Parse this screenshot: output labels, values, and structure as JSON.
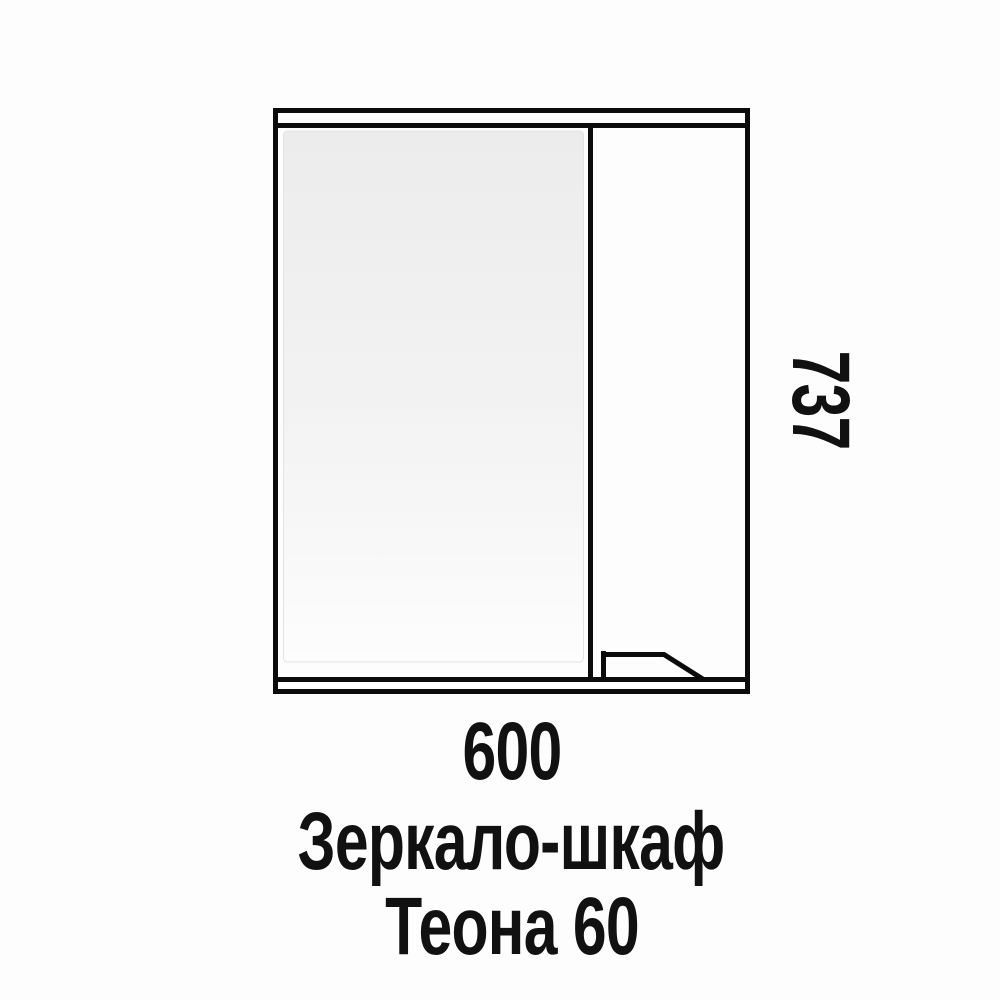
{
  "page": {
    "background": "#fdfdfd"
  },
  "drawing": {
    "stroke_color": "#0b0b0b",
    "mirror_top_color": "#ececec",
    "mirror_bottom_color": "#fdfdfd",
    "mirror_edge_color": "#e3e3e3",
    "width_mm": "600",
    "height_mm": "737"
  },
  "caption": {
    "product_type": "Зеркало-шкаф",
    "model": "Теона 60"
  }
}
